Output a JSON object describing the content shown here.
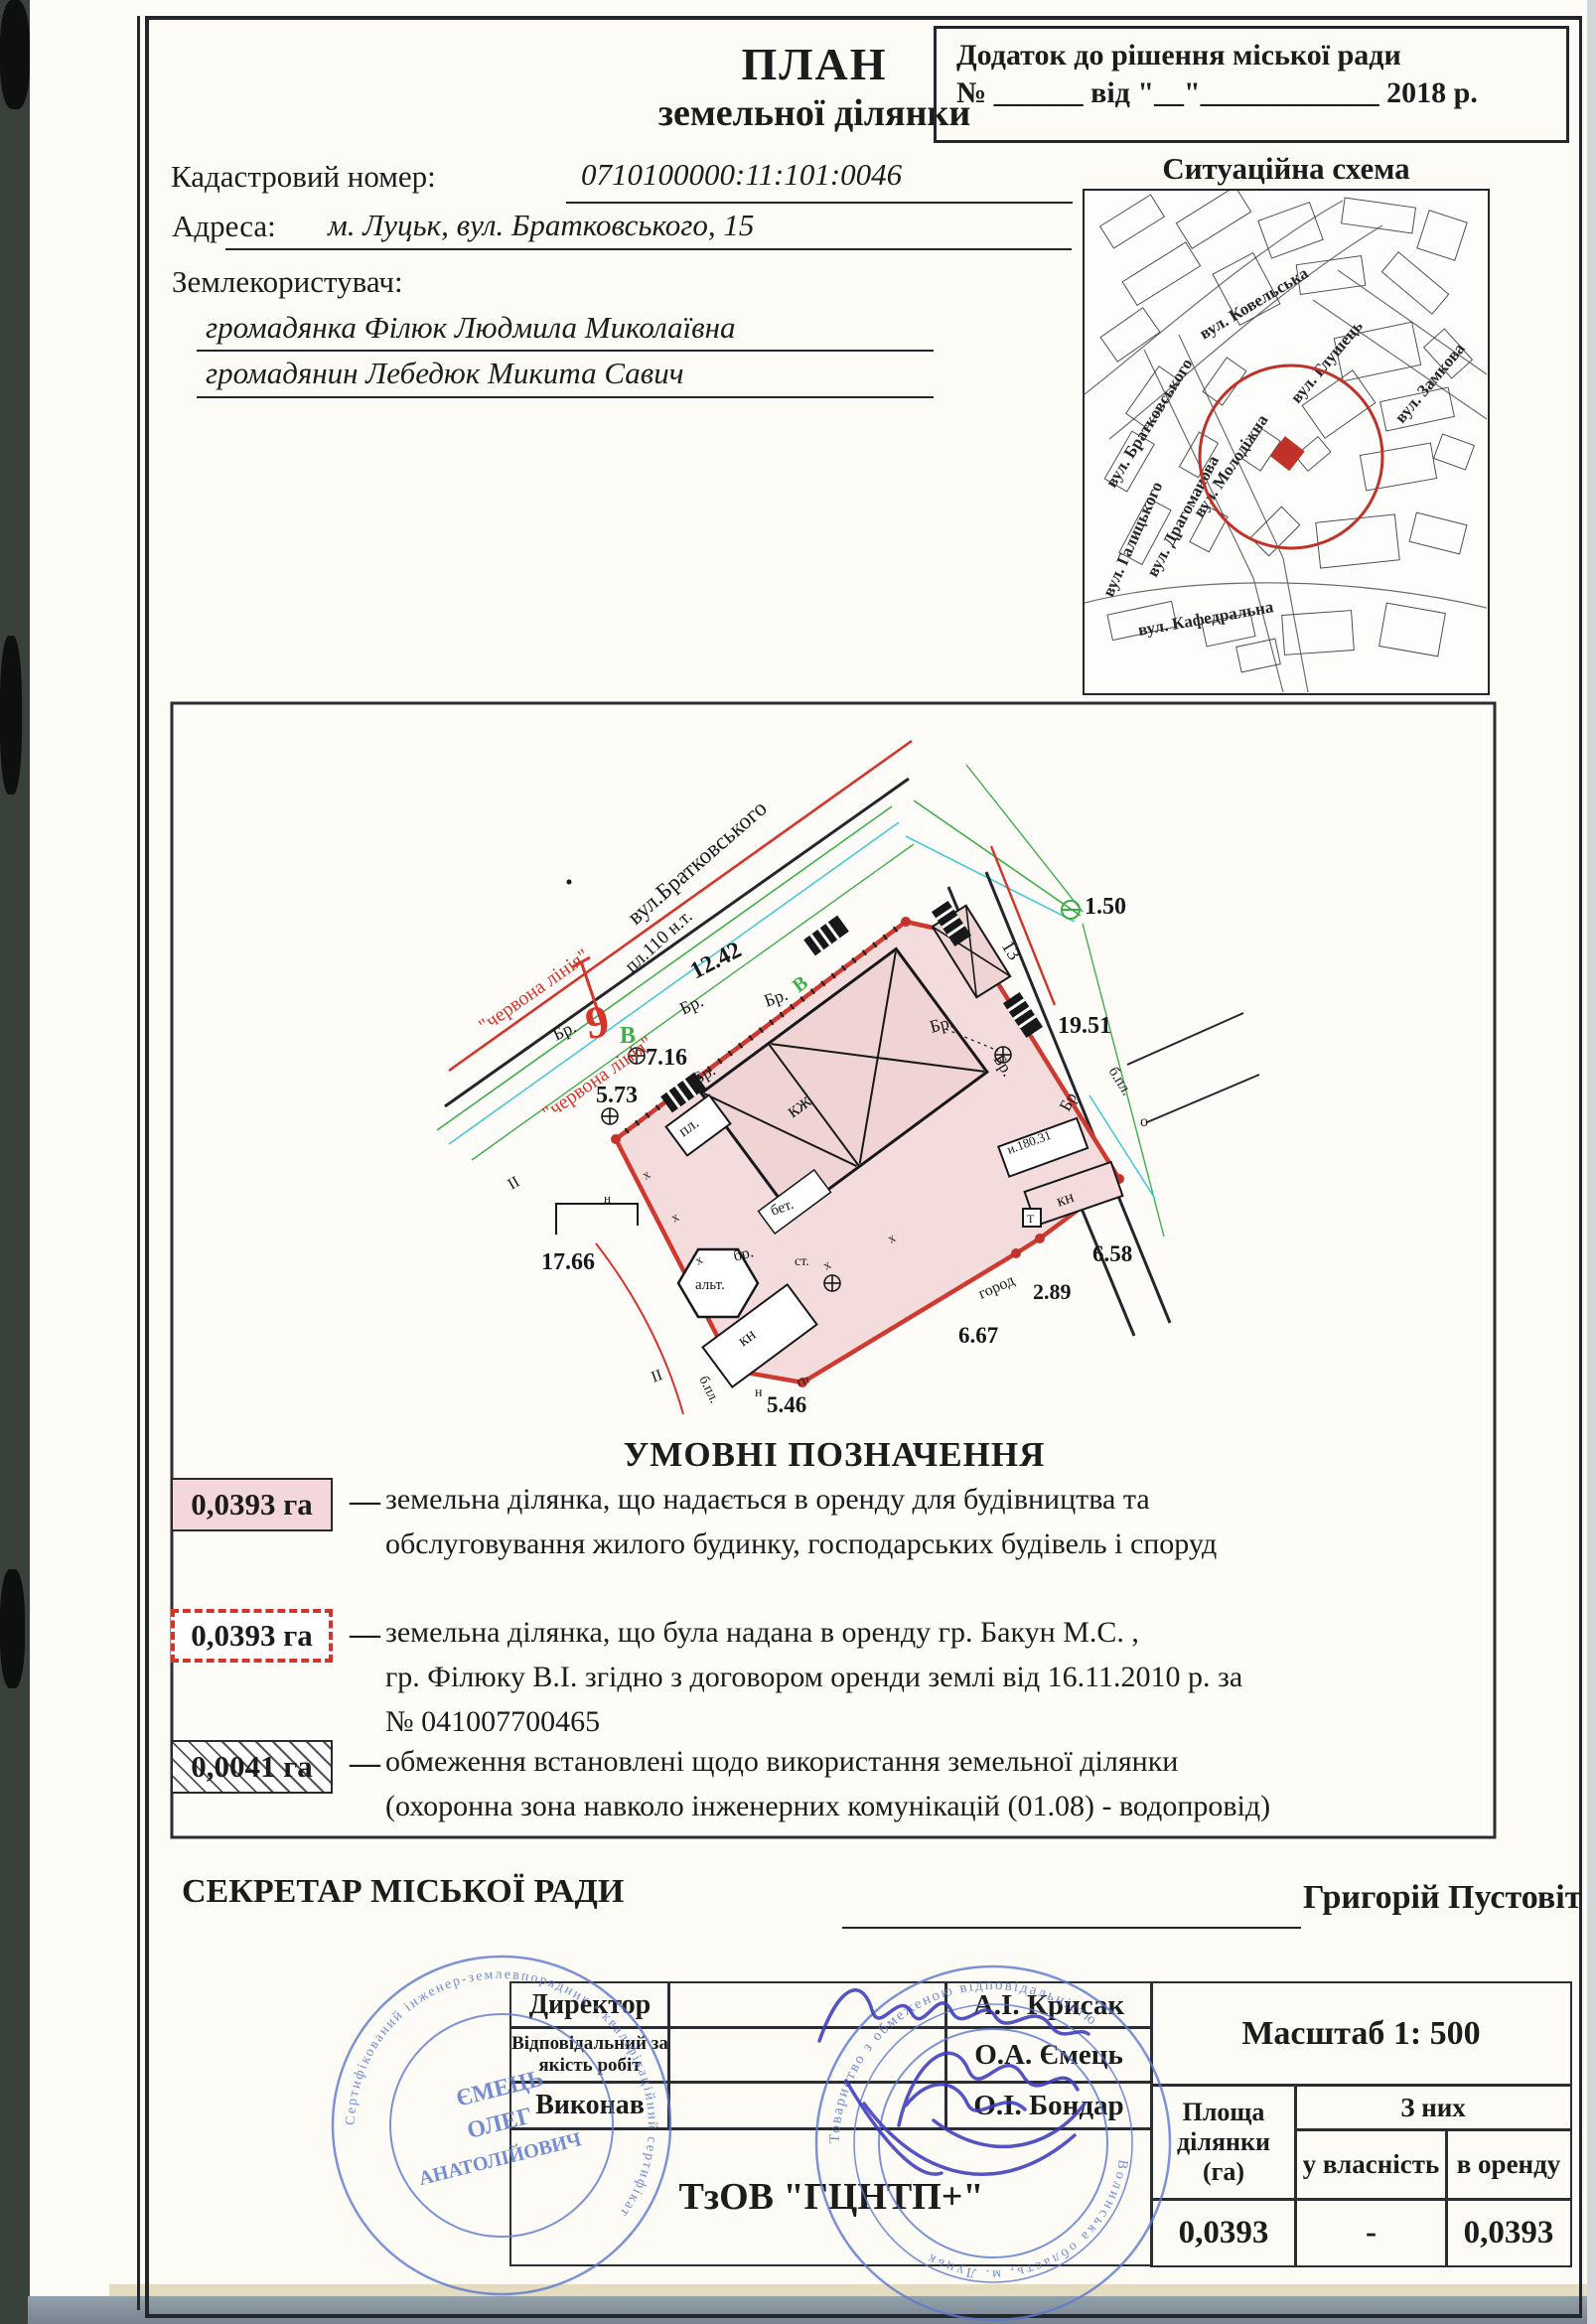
{
  "header": {
    "plan_title1": "ПЛАН",
    "plan_title2": "земельної ділянки",
    "annex_line1": "Додаток до рішення  міської ради",
    "annex_line2": "№ ______ від \"__\"____________ 2018 р.",
    "cadastral_label": "Кадастровий номер:",
    "cadastral_value": "0710100000:11:101:0046",
    "address_label": "Адреса:",
    "address_value": "м. Луцьк, вул. Братковського, 15",
    "landuser_label": "Землекористувач:",
    "landuser_1": "громадянка Філюк Людмила Миколаївна",
    "landuser_2": "громадянин Лебедюк Микита Савич",
    "situation_title": "Ситуаційна схема"
  },
  "situation_map": {
    "streets": [
      "вул. Ковельська",
      "вул. Братковського",
      "вул. Глушець",
      "вул. Замкова",
      "вул. Драгоманова",
      "вул. Галицького",
      "вул. Молодіжна",
      "вул. Кафедральна"
    ],
    "marker_color": "#c03127"
  },
  "plan": {
    "street": "вул.Братковського",
    "pl110": "пл.110 н.т.",
    "red_line": "\"червона лінія\"",
    "d_150": "1.50",
    "d_1242": "12.42",
    "d_1951": "19.51",
    "d_716": "7.16",
    "d_573": "5.73",
    "d_1766": "17.66",
    "d_658": "6.58",
    "d_289": "2.89",
    "d_667": "6.67",
    "d_546": "5.46",
    "d_13": "13",
    "n9": "9",
    "vB": "В",
    "br": "Бр.",
    "br_lc": "бр.",
    "kzh": "кж",
    "pl": "пл.",
    "kn": "кн",
    "alt": "альт.",
    "bet": "бет.",
    "gorod": "город",
    "st": "ст.",
    "gp": "гп",
    "bpl": "б.пл.",
    "o": "о",
    "n": "н",
    "x": "х",
    "ii": "ІІ",
    "t": "Т",
    "code": "и.180.31"
  },
  "legend": {
    "title": "УМОВНІ   ПОЗНАЧЕННЯ",
    "dash": "—",
    "items": [
      {
        "value": "0,0393 га",
        "line1": "земельна ділянка, що надається в оренду для будівництва та",
        "line2": "обслуговування жилого будинку, господарських будівель і споруд",
        "line3": ""
      },
      {
        "value": "0,0393 га",
        "line1": "земельна ділянка, що була надана в оренду гр. Бакун М.С. ,",
        "line2": "гр. Філюку В.І. згідно з договором оренди землі від 16.11.2010 р. за",
        "line3": "№ 041007700465"
      },
      {
        "value": "0,0041 га",
        "line1": "обмеження встановлені щодо використання земельної ділянки",
        "line2": "(охоронна зона навколо інженерних комунікацій (01.08) - водопровід)",
        "line3": ""
      }
    ]
  },
  "secretary": {
    "label": "СЕКРЕТАР МІСЬКОЇ РАДИ",
    "name": "Григорій Пустовіт"
  },
  "footer_table": {
    "rows": [
      {
        "role": "Директор",
        "name": "А.І. Крисак"
      },
      {
        "role": "Відповідальний за якість робіт",
        "name": "О.А. Ємець"
      },
      {
        "role": "Виконав",
        "name": "О.І. Бондар"
      }
    ],
    "company": "ТзОВ \"ГЦНТП+\"",
    "scale": "Масштаб  1: 500",
    "area_header": "Площа ділянки (га)",
    "of_them": "З них",
    "ownership": "у власність",
    "lease": "в оренду",
    "area_value": "0,0393",
    "ownership_value": "-",
    "lease_value": "0,0393"
  },
  "stamps": {
    "s1_ring": "Сертифікований інженер-землевпорядник • кваліфікаційний сертифікат",
    "s1_name1": "ЄМЕЦЬ",
    "s1_name2": "ОЛЕГ",
    "s1_name3": "АНАТОЛІЙОВИЧ",
    "s2_ring_top": "Товариство з обмеженою відповідальністю",
    "s2_ring_bottom": "Волинська область, м. Луцьк"
  }
}
